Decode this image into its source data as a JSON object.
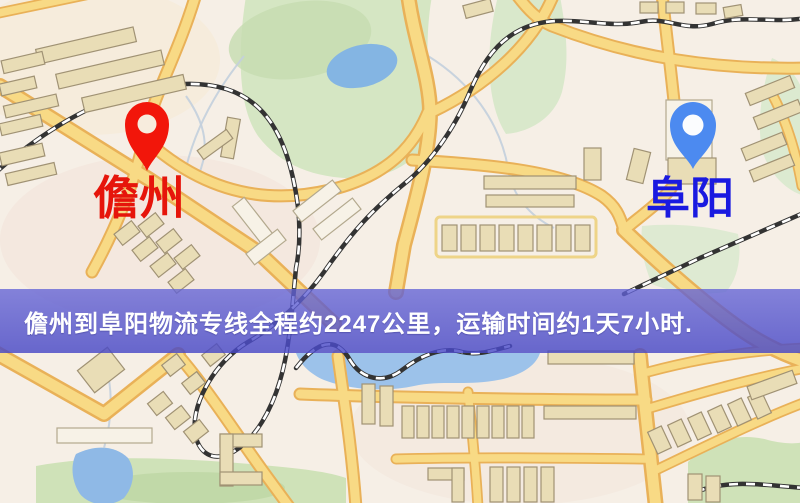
{
  "banner": {
    "text": "儋州到阜阳物流专线全程约2247公里，运输时间约1天7小时.",
    "origin": "儋州",
    "destination": "阜阳",
    "distance_text": "约2247公里",
    "duration_text": "约1天7小时",
    "background_color": "#5353cd",
    "text_color": "#ffffff"
  },
  "markers": {
    "origin": {
      "label": "儋州",
      "label_color": "#e6150b",
      "pin_color": "#f2160a",
      "pin_style": "map-pin"
    },
    "destination": {
      "label": "阜阳",
      "label_color": "#1a1ae0",
      "pin_color": "#4c8af0",
      "pin_style": "map-pin"
    }
  },
  "map_palette": {
    "land": "#f6efe6",
    "road_fill": "#f8da85",
    "road_casing": "#e9b158",
    "building": "#e9ddb6",
    "park": "#d5e6c3",
    "water": "#8cb9e6",
    "railway": "#333333"
  }
}
